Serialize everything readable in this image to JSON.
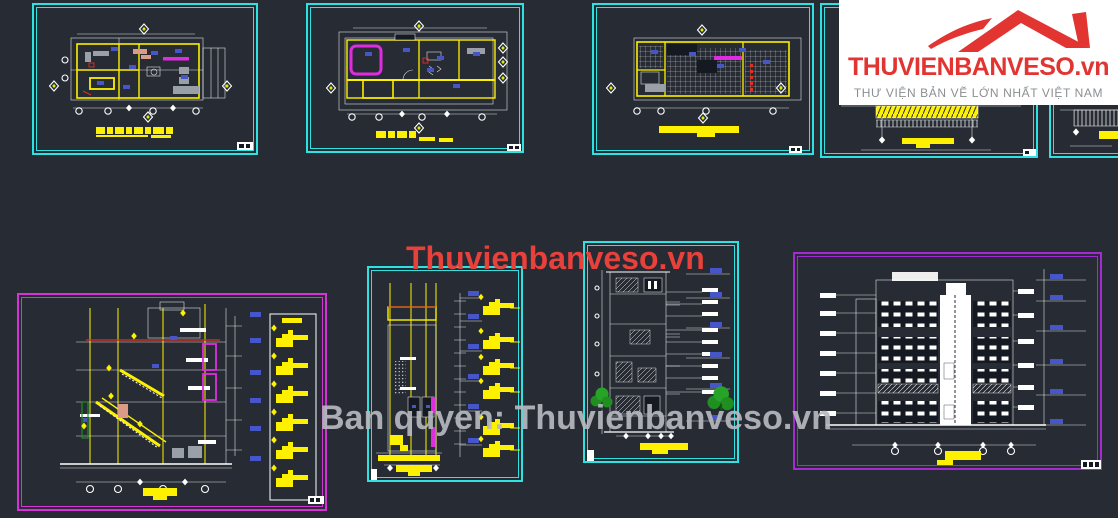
{
  "canvas": {
    "width": 1118,
    "height": 518
  },
  "logo": {
    "brand": "THUVIENBANVESO.vn",
    "tagline": "THƯ VIỆN BẢN VẼ LỚN NHẤT VIỆT NAM",
    "brand_color": "#e23532",
    "tagline_color": "#8b8f92",
    "background": "#ffffff"
  },
  "watermarks": {
    "center": "Thuvienbanveso.vn",
    "center_color": "#e8403a",
    "bottom": "Ban quyen: Thuvienbanveso.vn",
    "bottom_color": "#b6b9be"
  },
  "palette": {
    "bg": "#262b34",
    "cyan": "#2ee2e2",
    "yellow": "#fdf000",
    "magenta": "#e02ce0",
    "pink": "#d633d6",
    "purple": "#a62ad4",
    "red": "#e03022",
    "blue": "#4656c8",
    "green": "#1f8f1f",
    "gray": "#9aa0a8",
    "dark": "#141922",
    "wm-red": "#e8403a",
    "wm-gray": "#b6b9be",
    "logo-bg": "#ffffff",
    "brand": "#e23532",
    "tagline": "#8b8f92"
  },
  "frames": [
    {
      "name": "floor-plan-1",
      "border": "#2ee2e2"
    },
    {
      "name": "floor-plan-2",
      "border": "#2ee2e2"
    },
    {
      "name": "floor-plan-3",
      "border": "#2ee2e2"
    },
    {
      "name": "roof-section-strip",
      "border": "#2ee2e2"
    },
    {
      "name": "roof-section-strip-partial",
      "border": "#2ee2e2"
    },
    {
      "name": "cross-section",
      "border": "#d633d6"
    },
    {
      "name": "longitudinal-section",
      "border": "#2ee2e2"
    },
    {
      "name": "front-elevation",
      "border": "#2ee2e2"
    },
    {
      "name": "side-elevation",
      "border": "#a62ad4"
    }
  ]
}
